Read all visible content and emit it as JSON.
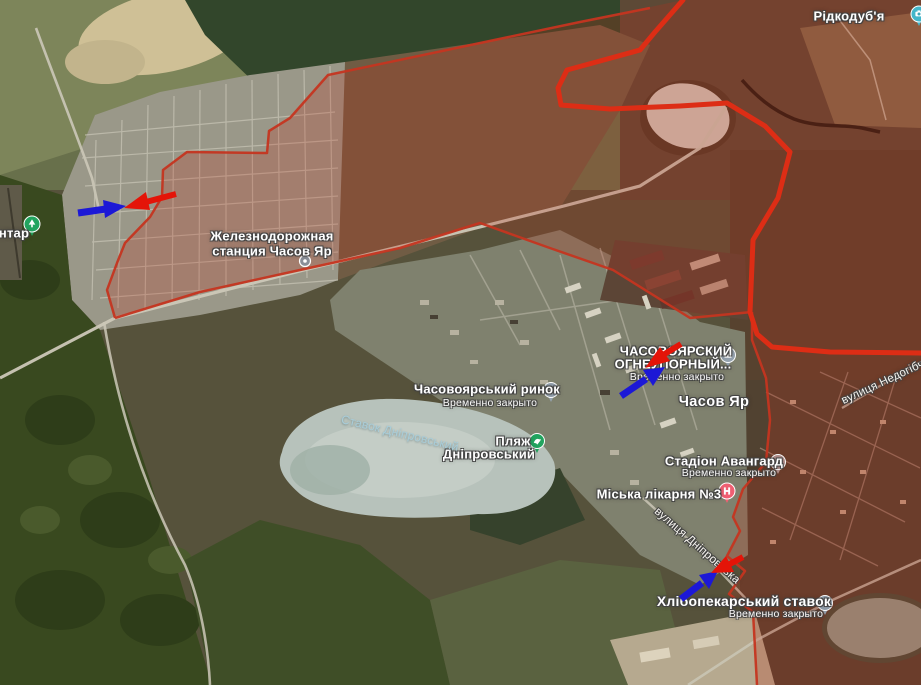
{
  "map": {
    "place_labels": {
      "ridkodubya": "Рідкодуб'я",
      "station_line1": "Железнодорожная",
      "station_line2": "станция Часов Яр",
      "market": "Часовоярський ринок",
      "factory_line1": "ЧАСОВОЯРСКИЙ",
      "factory_line2": "ОГНЕУПОРНЫЙ...",
      "temporarily_closed": "Временно закрыто",
      "town": "Часов Яр",
      "beach_line1": "Пляж",
      "beach_line2": "Дніпровський",
      "lake": "Ставок Дніпровський",
      "stadium": "Стадіон Авангард",
      "hospital": "Міська лікарня №3",
      "street_dniprovska": "вулиця Дніпровська",
      "street_nedohibche": "вулиця Недогібче",
      "cemetery_fragment": "нтар",
      "pond": "Хлібопекарський ставок"
    },
    "colors": {
      "occupied_fill": "#c22c18",
      "front_line": "#dd2d15",
      "zone_border": "#c53520",
      "arrow_blue": "#1c18d6",
      "arrow_red": "#e41408",
      "pin_camera": "#44b6ca",
      "pin_gray": "#95a2af",
      "pin_green": "#22a45f",
      "pin_hospital": "#ef5f72",
      "pin_stadium": "#b5928e",
      "pin_station": "#8a8f98"
    }
  }
}
